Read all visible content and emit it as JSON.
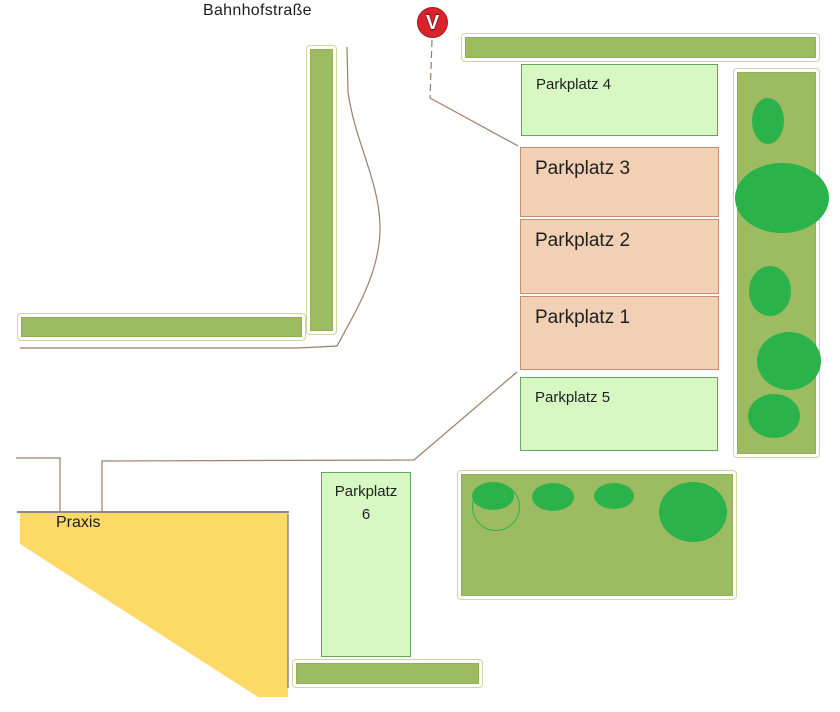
{
  "street": {
    "label": "Bahnhofstraße"
  },
  "marker": {
    "label": "V",
    "color": "#d8232a"
  },
  "building": {
    "label": "Praxis",
    "color": "#fcda65"
  },
  "lots": [
    {
      "id": "parkplatz-4",
      "label": "Parkplatz 4",
      "style": "green"
    },
    {
      "id": "parkplatz-3",
      "label": "Parkplatz 3",
      "style": "tan"
    },
    {
      "id": "parkplatz-2",
      "label": "Parkplatz 2",
      "style": "tan"
    },
    {
      "id": "parkplatz-1",
      "label": "Parkplatz 1",
      "style": "tan"
    },
    {
      "id": "parkplatz-5",
      "label": "Parkplatz 5",
      "style": "green"
    },
    {
      "id": "parkplatz-6",
      "label": "Parkplatz 6",
      "style": "green"
    }
  ],
  "colors": {
    "hedge_green": "#9dbb61",
    "tree_green": "#2cb24b",
    "lot_light_green": "#d7f7c3",
    "lot_green_border": "#67a566",
    "lot_tan": "#f2d0b4",
    "lot_tan_border": "#c38d70",
    "building_yellow": "#fcda65",
    "building_border_gray": "#8a8a8a",
    "road_line_brown": "#9d7f6b",
    "marker_red": "#d8232a"
  }
}
